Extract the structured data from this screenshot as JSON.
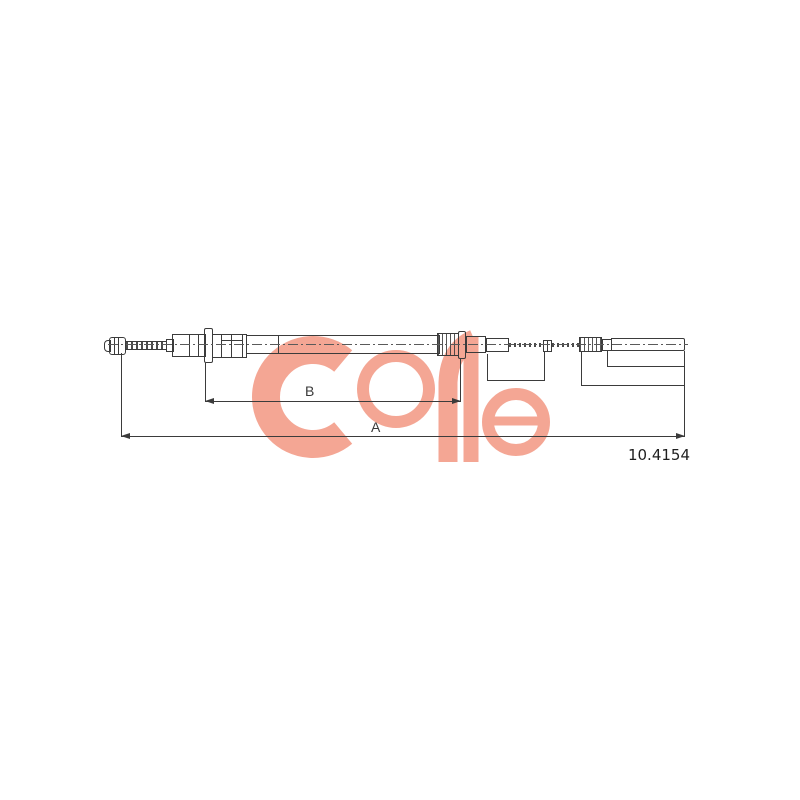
{
  "brand": {
    "name": "COFLE",
    "color": "#f2907a"
  },
  "part": {
    "number": "10.4154"
  },
  "dimensions": {
    "a_label": "A",
    "b_label": "B"
  },
  "colors": {
    "line": "#3b3b3b",
    "background": "#ffffff"
  }
}
